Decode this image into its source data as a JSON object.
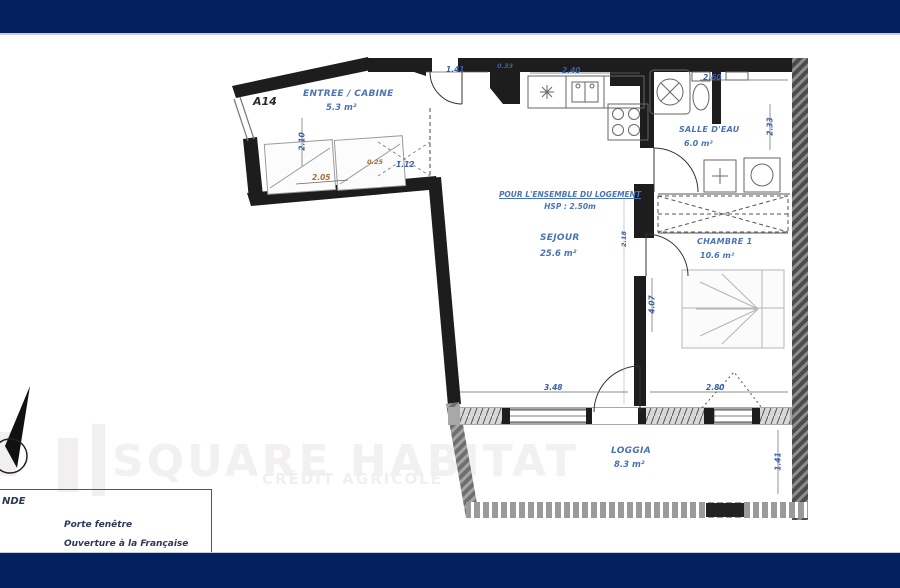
{
  "colors": {
    "bar": "#03215f",
    "dim_blue": "#3a5fa8",
    "dim_orange": "#b06a32",
    "room_label": "#4a74b5",
    "wall": "#1d1d1d",
    "watermark": "#f2f0f1"
  },
  "watermark": {
    "line1": "SQUARE HABITAT",
    "line2": "CRÉDIT AGRICOLE"
  },
  "plan": {
    "unit": "A14",
    "note": {
      "line1": "POUR L'ENSEMBLE DU LOGEMENT",
      "line2": "HSP : 2.50m"
    },
    "rooms": [
      {
        "name": "ENTREE / CABINE",
        "area": "5.3 m²"
      },
      {
        "name": "SEJOUR",
        "area": "25.6 m²"
      },
      {
        "name": "SALLE D'EAU",
        "area": "6.0 m²"
      },
      {
        "name": "CHAMBRE 1",
        "area": "10.6 m²"
      },
      {
        "name": "LOGGIA",
        "area": "8.3 m²"
      }
    ],
    "dims": {
      "entry": "1.41",
      "duct": "0.33",
      "kitchen": "2.40",
      "bath_w": "2.60",
      "bath_d": "2.33",
      "cabine_d": "2.10",
      "cabine_w": "2.05",
      "cabine_s": "0.25",
      "cabine_c": "1.12",
      "mid": "2.18",
      "sejour_w": "3.48",
      "chambre_w": "2.80",
      "chambre_d": "4.07",
      "loggia_d": "1.41"
    }
  },
  "legend": {
    "title_visible": "NDE",
    "items": [
      "Porte fenêtre",
      "Ouverture à la Française"
    ]
  }
}
